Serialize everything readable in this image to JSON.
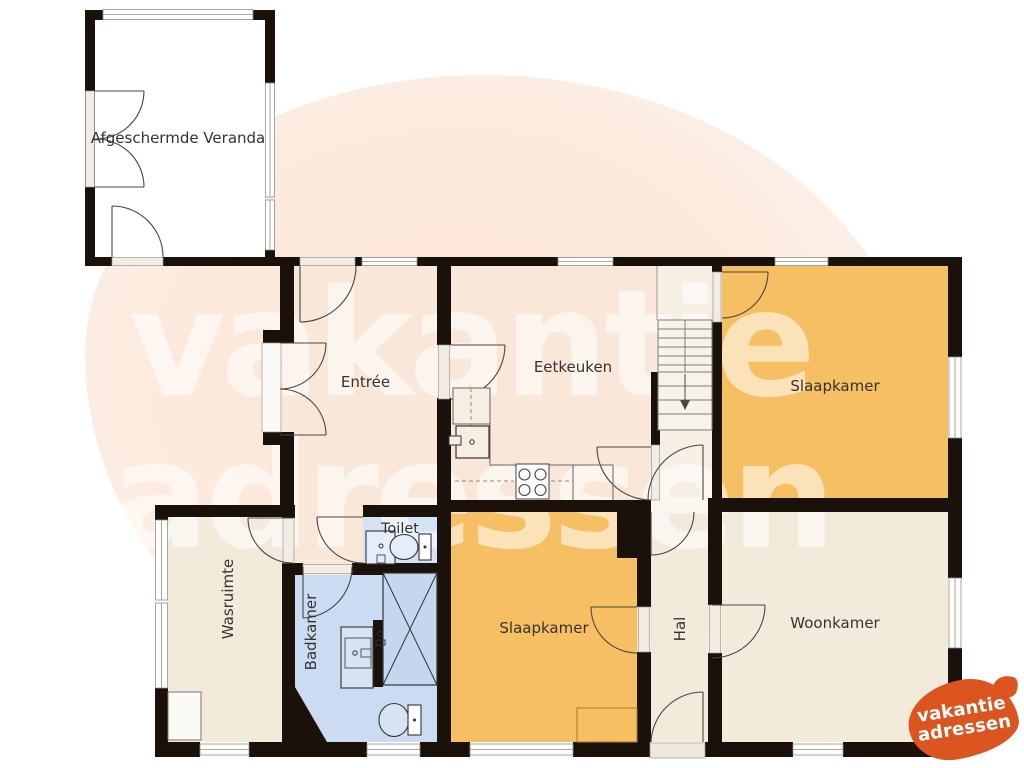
{
  "plan": {
    "rooms": {
      "veranda": {
        "label": "Afgeschermde Veranda"
      },
      "entree": {
        "label": "Entrée"
      },
      "eetkeuken": {
        "label": "Eetkeuken"
      },
      "slaapkamer_boven": {
        "label": "Slaapkamer"
      },
      "slaapkamer_beneden": {
        "label": "Slaapkamer"
      },
      "toilet": {
        "label": "Toilet"
      },
      "wasruimte": {
        "label": "Wasruimte"
      },
      "badkamer": {
        "label": "Badkamer"
      },
      "hal": {
        "label": "Hal"
      },
      "woonkamer": {
        "label": "Woonkamer"
      }
    },
    "colors": {
      "wall": "#19110a",
      "room_cream_warm": "#f9e8d9",
      "room_cream": "#f2ebdc",
      "room_orange": "#f6bf63",
      "room_blue_toilet": "#d4e2f4",
      "room_blue_bath": "#cbdcf2",
      "veranda_white": "#ffffff",
      "logo_orange": "#dc5420",
      "watermark_tint": "#fbe3d3"
    }
  },
  "watermark": {
    "line1": "vakantie",
    "line2": "adressen"
  },
  "logo": {
    "line1": "vakantie",
    "line2": "adressen"
  }
}
